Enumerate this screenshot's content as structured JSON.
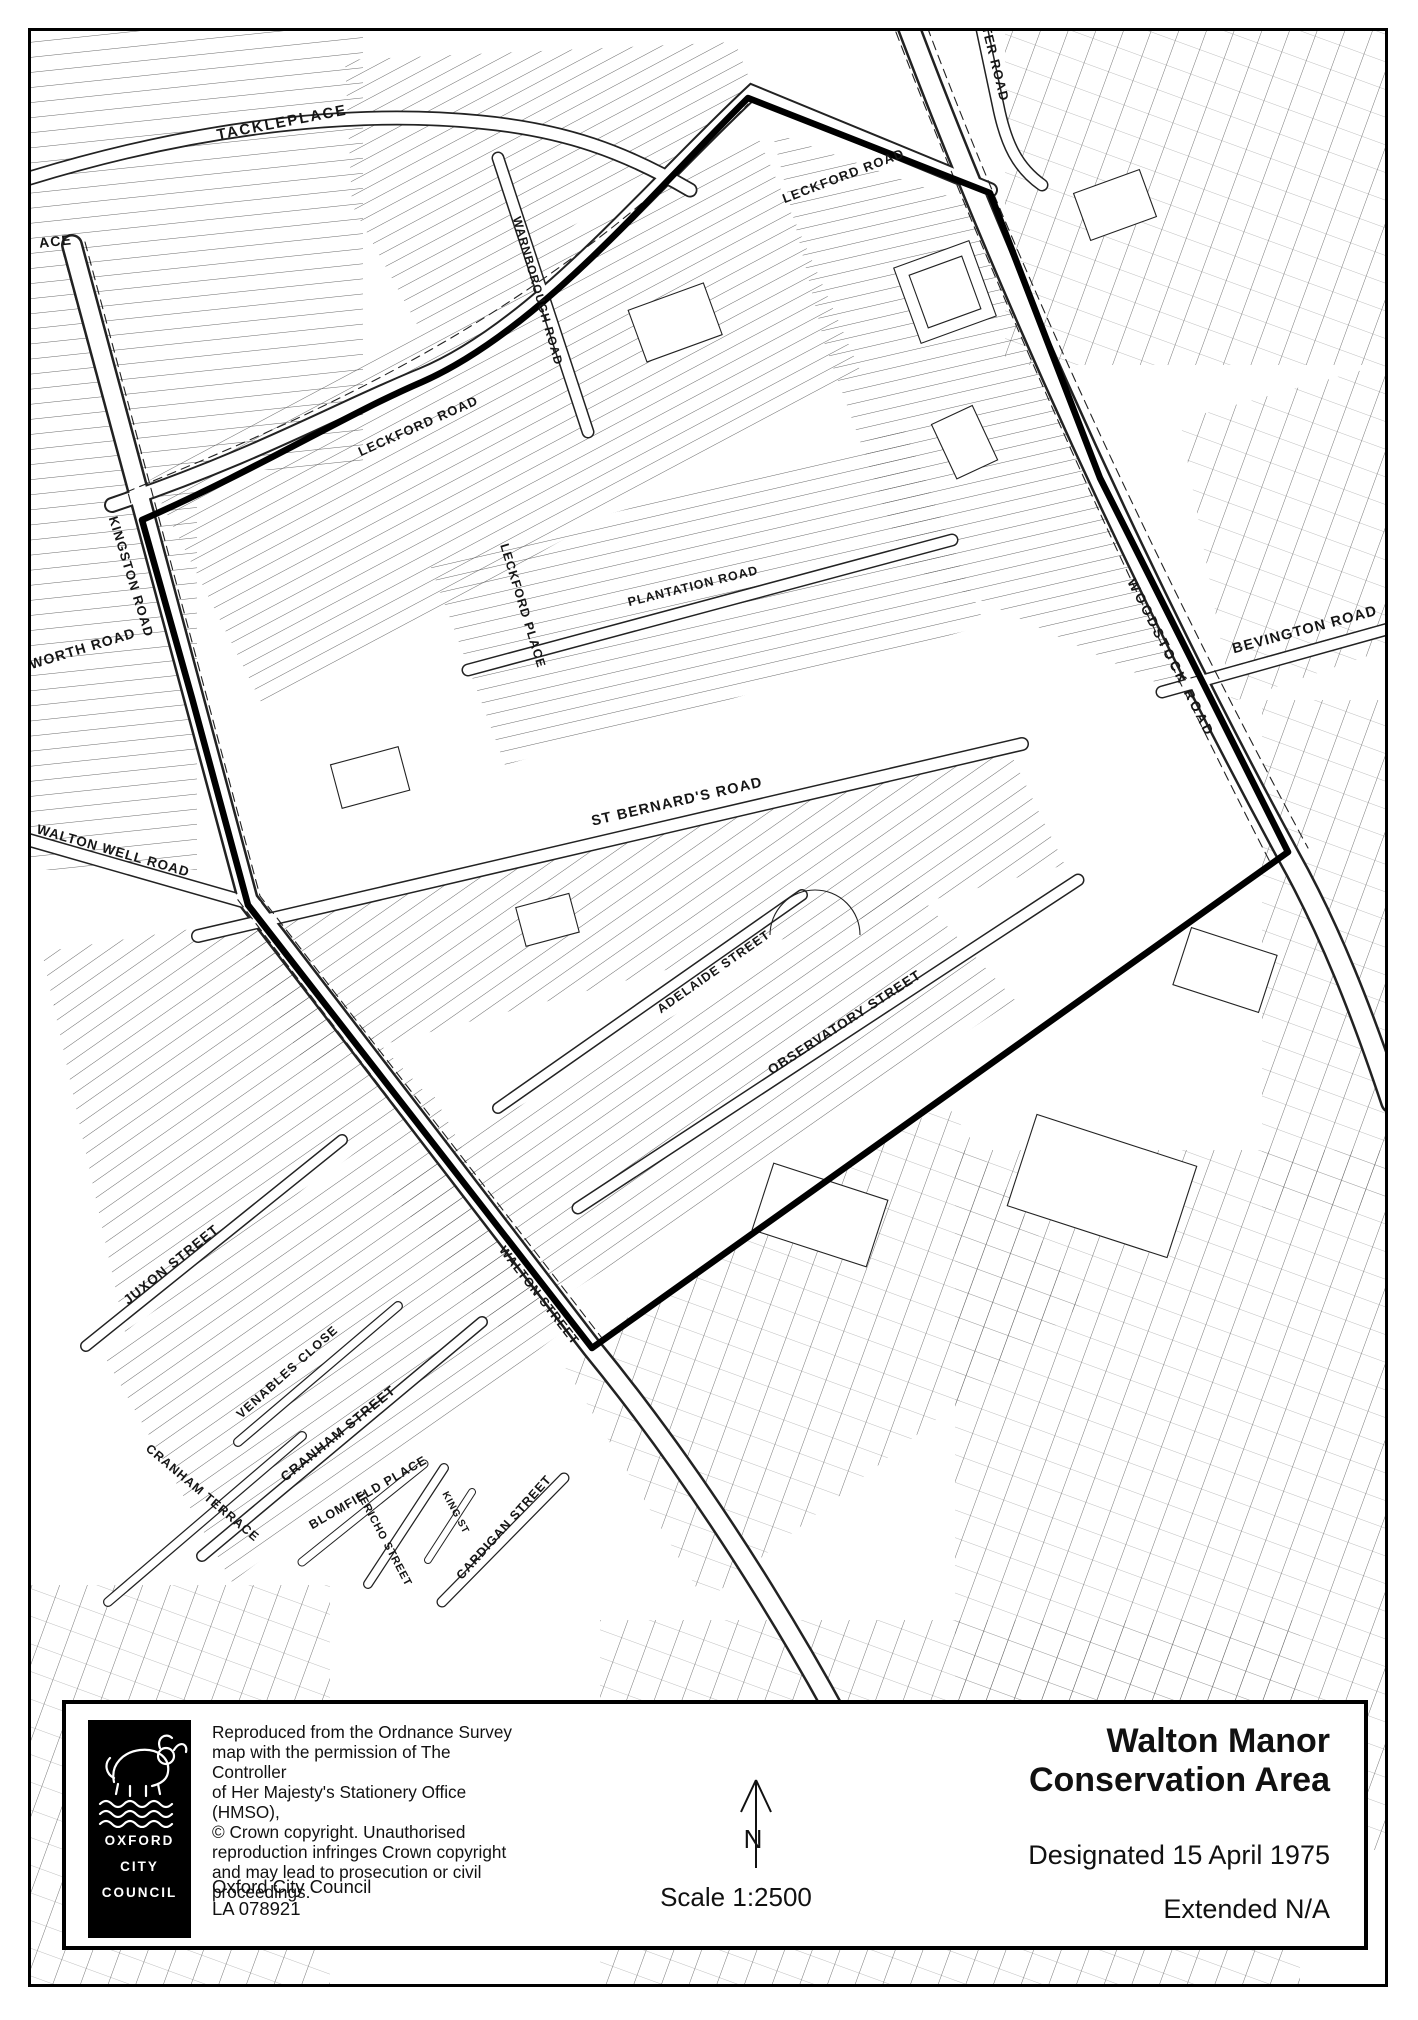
{
  "panel": {
    "title_line1": "Walton Manor",
    "title_line2": "Conservation Area",
    "designated": "Designated 15 April 1975",
    "extended": "Extended N/A",
    "scale_label": "Scale 1:2500",
    "north_label": "N",
    "copyright_lines": [
      "Reproduced from the Ordnance Survey",
      "map with the permission of The Controller",
      "of Her Majesty's Stationery Office (HMSO),",
      "© Crown copyright. Unauthorised",
      "reproduction infringes Crown copyright",
      "and may lead to prosecution or civil",
      "proceedings."
    ],
    "council_line1": "Oxford City Council",
    "council_line2": "LA 078921",
    "logo": {
      "line1": "OXFORD",
      "line2": "CITY",
      "line3": "COUNCIL"
    }
  },
  "map": {
    "ink_color": "#111111",
    "boundary_color": "#000000",
    "streets": [
      {
        "name": "TACKLEPLACE"
      },
      {
        "name": "LECKFORD ROAD"
      },
      {
        "name": "STER ROAD"
      },
      {
        "name": "WARNBOROUGH ROAD"
      },
      {
        "name": "LECKFORD ROAD"
      },
      {
        "name": "KINGSTON ROAD"
      },
      {
        "name": "WORTH ROAD"
      },
      {
        "name": "ACE"
      },
      {
        "name": "LECKFORD PLACE"
      },
      {
        "name": "PLANTATION ROAD"
      },
      {
        "name": "ST BERNARD'S ROAD"
      },
      {
        "name": "BEVINGTON ROAD"
      },
      {
        "name": "WOODSTOCK ROAD"
      },
      {
        "name": "WALTON WELL ROAD"
      },
      {
        "name": "ADELAIDE STREET"
      },
      {
        "name": "OBSERVATORY STREET"
      },
      {
        "name": "JUXON STREET"
      },
      {
        "name": "VENABLES CLOSE"
      },
      {
        "name": "CRANHAM STREET"
      },
      {
        "name": "CRANHAM TERRACE"
      },
      {
        "name": "BLOMFIELD PLACE"
      },
      {
        "name": "JERICHO STREET"
      },
      {
        "name": "KING ST"
      },
      {
        "name": "CARDIGAN STREET"
      },
      {
        "name": "WALTON STREET"
      }
    ]
  }
}
